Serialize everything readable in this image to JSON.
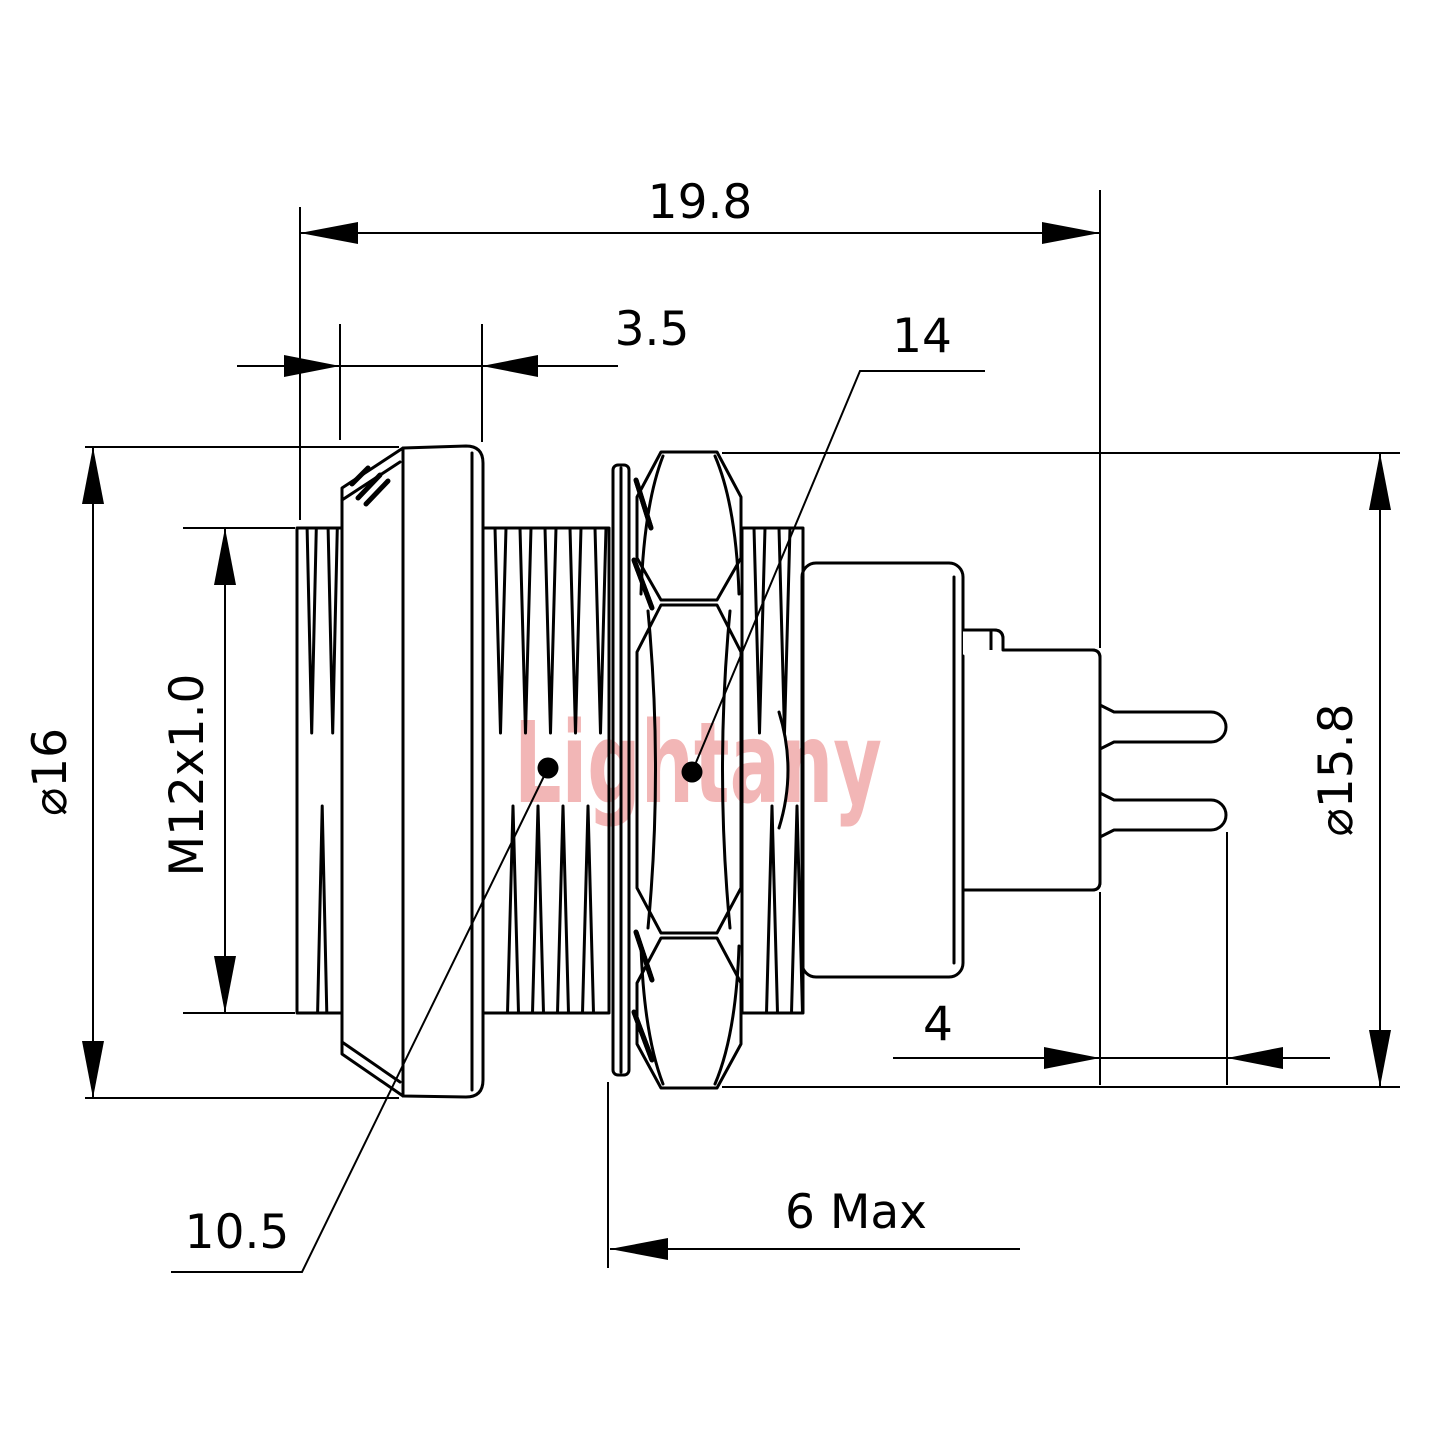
{
  "watermark": "Lightany",
  "dims": {
    "overall_length": "19.8",
    "flange_thickness": "3.5",
    "hex_across_flats": "14",
    "flange_diameter": "⌀16",
    "thread_spec": "M12x1.0",
    "nut_diameter": "⌀15.8",
    "front_inner": "10.5",
    "panel_thread_length": "6 Max",
    "pin_length": "4"
  },
  "colors": {
    "line": "#000000",
    "watermark": "#f2b6b6",
    "background": "#ffffff"
  }
}
